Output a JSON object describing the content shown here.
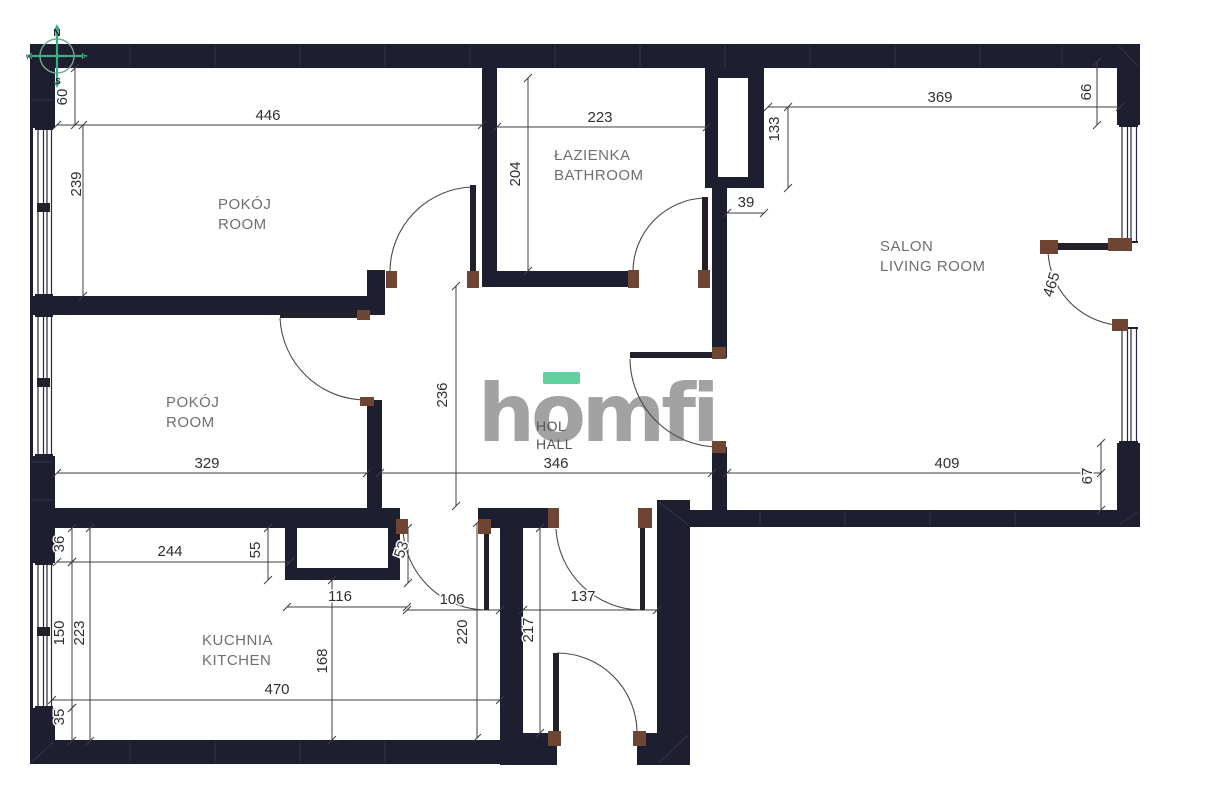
{
  "plan": {
    "canvas": {
      "w": 1208,
      "h": 811
    },
    "colors": {
      "bg": "#ffffff",
      "wall": "#1e1e31",
      "seam": "#32324a",
      "windowLine": "#2a2a3a",
      "dimLine": "#3d3d3d",
      "dimText": "#2f2f2f",
      "roomLabel": "#6f6f6f",
      "hallLabel": "#565656",
      "doorArc": "#4a4a4a",
      "doorLeaf": "#23202a",
      "doorJamb": "#6e4433",
      "logoGray": "#a2a2a2",
      "logoGreen": "#62d1a2",
      "compassGreen": "#3fae7f",
      "compassRing": "#79a892",
      "compassText": "#1a1a2e"
    },
    "walls": [
      [
        30,
        44,
        1110,
        24
      ],
      [
        30,
        44,
        25,
        718
      ],
      [
        1117,
        44,
        23,
        483
      ],
      [
        30,
        740,
        477,
        24
      ],
      [
        500,
        733,
        57,
        32
      ],
      [
        637,
        733,
        53,
        32
      ],
      [
        500,
        508,
        23,
        235
      ],
      [
        657,
        500,
        33,
        265
      ],
      [
        657,
        510,
        483,
        17
      ],
      [
        30,
        508,
        370,
        20
      ],
      [
        478,
        508,
        77,
        20
      ],
      [
        30,
        296,
        338,
        19
      ],
      [
        367,
        270,
        18,
        45
      ],
      [
        367,
        400,
        15,
        110
      ],
      [
        482,
        44,
        15,
        243
      ],
      [
        482,
        271,
        155,
        16
      ],
      [
        705,
        44,
        13,
        144
      ],
      [
        748,
        44,
        16,
        144
      ],
      [
        705,
        177,
        59,
        11
      ],
      [
        705,
        68,
        59,
        10
      ],
      [
        712,
        188,
        15,
        170
      ],
      [
        712,
        447,
        15,
        63
      ],
      [
        285,
        528,
        12,
        52
      ],
      [
        388,
        528,
        12,
        52
      ],
      [
        285,
        568,
        115,
        12
      ]
    ],
    "seams": [
      [
        130,
        45,
        130,
        67
      ],
      [
        215,
        45,
        215,
        67
      ],
      [
        300,
        45,
        300,
        67
      ],
      [
        385,
        45,
        385,
        67
      ],
      [
        470,
        45,
        470,
        67
      ],
      [
        555,
        45,
        555,
        67
      ],
      [
        640,
        45,
        640,
        67
      ],
      [
        725,
        45,
        725,
        67
      ],
      [
        810,
        45,
        810,
        67
      ],
      [
        895,
        45,
        895,
        67
      ],
      [
        980,
        45,
        980,
        67
      ],
      [
        1062,
        45,
        1062,
        67
      ],
      [
        1119,
        46,
        1138,
        66
      ],
      [
        31,
        100,
        54,
        100
      ],
      [
        31,
        462,
        54,
        462
      ],
      [
        31,
        500,
        54,
        500
      ],
      [
        130,
        741,
        130,
        763
      ],
      [
        215,
        741,
        215,
        763
      ],
      [
        300,
        741,
        300,
        763
      ],
      [
        385,
        741,
        385,
        763
      ],
      [
        32,
        762,
        53,
        742
      ],
      [
        760,
        511,
        760,
        526
      ],
      [
        845,
        511,
        845,
        526
      ],
      [
        930,
        511,
        930,
        526
      ],
      [
        1015,
        511,
        1015,
        526
      ],
      [
        1119,
        525,
        1138,
        512
      ],
      [
        659,
        502,
        688,
        525
      ],
      [
        659,
        763,
        688,
        735
      ]
    ],
    "windows": [
      {
        "x": 33,
        "y": 128,
        "w": 22,
        "h": 168,
        "mull": 207
      },
      {
        "x": 33,
        "y": 315,
        "w": 22,
        "h": 141,
        "mull": 382
      },
      {
        "x": 33,
        "y": 563,
        "w": 22,
        "h": 145,
        "mull": 631
      },
      {
        "x": 1117,
        "y": 125,
        "w": 23,
        "h": 118,
        "mull": null
      },
      {
        "x": 1117,
        "y": 327,
        "w": 23,
        "h": 116,
        "mull": null
      }
    ],
    "openings": [
      [
        1117,
        243,
        23,
        84
      ]
    ],
    "door_leaves": [
      [
        470,
        185,
        6,
        88
      ],
      [
        280,
        312,
        87,
        6
      ],
      [
        702,
        197,
        6,
        76
      ],
      [
        630,
        352,
        90,
        6
      ],
      [
        484,
        528,
        5,
        82
      ],
      [
        640,
        525,
        5,
        85
      ],
      [
        553,
        653,
        6,
        80
      ],
      [
        1048,
        243,
        82,
        7
      ]
    ],
    "door_arcs": [
      "M390 272 A85 85 0 0 1 473 187",
      "M280 318 A86 86 0 0 0 366 400",
      "M633 271 A74 74 0 0 1 704 198",
      "M630 359 A89 89 0 0 0 719 447",
      "M403 529 A84 84 0 0 0 487 610",
      "M556 529 A86 86 0 0 0 641 610",
      "M637 732 A80 80 0 0 0 557 653",
      "M1048 250 A77 77 0 0 0 1116 325"
    ],
    "jambs": [
      [
        386,
        271,
        11,
        17
      ],
      [
        467,
        271,
        12,
        17
      ],
      [
        357,
        310,
        13,
        10
      ],
      [
        360,
        397,
        14,
        9
      ],
      [
        628,
        270,
        11,
        18
      ],
      [
        698,
        270,
        12,
        18
      ],
      [
        712,
        347,
        14,
        12
      ],
      [
        712,
        441,
        14,
        12
      ],
      [
        396,
        519,
        12,
        15
      ],
      [
        478,
        519,
        13,
        15
      ],
      [
        548,
        508,
        11,
        20
      ],
      [
        638,
        508,
        14,
        20
      ],
      [
        548,
        731,
        13,
        15
      ],
      [
        633,
        731,
        13,
        15
      ],
      [
        1040,
        240,
        18,
        14
      ],
      [
        1108,
        238,
        24,
        13
      ],
      [
        1112,
        319,
        16,
        12
      ]
    ],
    "dim_lines": [
      [
        57,
        125,
        482,
        125
      ],
      [
        497,
        127,
        707,
        127
      ],
      [
        768,
        107,
        1120,
        107
      ],
      [
        727,
        213,
        764,
        213
      ],
      [
        57,
        473,
        367,
        473
      ],
      [
        380,
        473,
        712,
        473
      ],
      [
        727,
        473,
        1101,
        473
      ],
      [
        57,
        562,
        290,
        562
      ],
      [
        287,
        607,
        407,
        607
      ],
      [
        407,
        610,
        500,
        610
      ],
      [
        523,
        610,
        657,
        610
      ],
      [
        52,
        700,
        500,
        700
      ],
      [
        75,
        68,
        75,
        125
      ],
      [
        83,
        125,
        83,
        296
      ],
      [
        528,
        78,
        528,
        271
      ],
      [
        788,
        107,
        788,
        188
      ],
      [
        1097,
        62,
        1097,
        125
      ],
      [
        456,
        286,
        456,
        506
      ],
      [
        1101,
        443,
        1101,
        510
      ],
      [
        72,
        528,
        72,
        562
      ],
      [
        268,
        528,
        268,
        580
      ],
      [
        408,
        528,
        408,
        583
      ],
      [
        72,
        562,
        72,
        708
      ],
      [
        90,
        528,
        90,
        741
      ],
      [
        72,
        708,
        72,
        741
      ],
      [
        477,
        523,
        477,
        738
      ],
      [
        540,
        528,
        540,
        733
      ],
      [
        332,
        580,
        332,
        740
      ]
    ],
    "dim_labels": [
      {
        "t": "446",
        "x": 268,
        "y": 120,
        "r": 0
      },
      {
        "t": "223",
        "x": 600,
        "y": 122,
        "r": 0
      },
      {
        "t": "369",
        "x": 940,
        "y": 102,
        "r": 0
      },
      {
        "t": "39",
        "x": 746,
        "y": 207,
        "r": 0
      },
      {
        "t": "329",
        "x": 207,
        "y": 468,
        "r": 0
      },
      {
        "t": "346",
        "x": 556,
        "y": 468,
        "r": 0
      },
      {
        "t": "409",
        "x": 947,
        "y": 468,
        "r": 0
      },
      {
        "t": "244",
        "x": 170,
        "y": 556,
        "r": 0
      },
      {
        "t": "116",
        "x": 340,
        "y": 601,
        "r": 0
      },
      {
        "t": "106",
        "x": 452,
        "y": 604,
        "r": 0
      },
      {
        "t": "137",
        "x": 583,
        "y": 601,
        "r": 0
      },
      {
        "t": "470",
        "x": 277,
        "y": 694,
        "r": 0
      },
      {
        "t": "60",
        "x": 67,
        "y": 97,
        "r": -90
      },
      {
        "t": "239",
        "x": 81,
        "y": 184,
        "r": -90
      },
      {
        "t": "204",
        "x": 520,
        "y": 174,
        "r": -90
      },
      {
        "t": "133",
        "x": 779,
        "y": 129,
        "r": -90
      },
      {
        "t": "66",
        "x": 1091,
        "y": 92,
        "r": -90
      },
      {
        "t": "236",
        "x": 447,
        "y": 395,
        "r": -90
      },
      {
        "t": "465",
        "x": 1056,
        "y": 286,
        "r": -72
      },
      {
        "t": "67",
        "x": 1092,
        "y": 476,
        "r": -90
      },
      {
        "t": "36",
        "x": 64,
        "y": 544,
        "r": -90
      },
      {
        "t": "55",
        "x": 260,
        "y": 550,
        "r": -90
      },
      {
        "t": "53",
        "x": 406,
        "y": 551,
        "r": -72
      },
      {
        "t": "150",
        "x": 64,
        "y": 633,
        "r": -90
      },
      {
        "t": "223",
        "x": 84,
        "y": 633,
        "r": -90
      },
      {
        "t": "35",
        "x": 64,
        "y": 717,
        "r": -90
      },
      {
        "t": "220",
        "x": 467,
        "y": 632,
        "r": -90
      },
      {
        "t": "217",
        "x": 533,
        "y": 630,
        "r": -90
      },
      {
        "t": "168",
        "x": 327,
        "y": 661,
        "r": -90
      }
    ],
    "room_labels": [
      {
        "name": "room-1",
        "lines": [
          "POKÓJ",
          "ROOM"
        ],
        "x": 218,
        "y": 209,
        "lh": 20,
        "fs": 15
      },
      {
        "name": "bathroom",
        "lines": [
          "ŁAZIENKA",
          "BATHROOM"
        ],
        "x": 554,
        "y": 160,
        "lh": 20,
        "fs": 15
      },
      {
        "name": "living-room",
        "lines": [
          "SALON",
          "LIVING ROOM"
        ],
        "x": 880,
        "y": 251,
        "lh": 20,
        "fs": 15
      },
      {
        "name": "room-2",
        "lines": [
          "POKÓJ",
          "ROOM"
        ],
        "x": 166,
        "y": 407,
        "lh": 20,
        "fs": 15
      },
      {
        "name": "kitchen",
        "lines": [
          "KUCHNIA",
          "KITCHEN"
        ],
        "x": 202,
        "y": 645,
        "lh": 20,
        "fs": 15
      },
      {
        "name": "hall",
        "lines": [
          "HOL",
          "HALL"
        ],
        "x": 536,
        "y": 431,
        "lh": 18,
        "fs": 14
      }
    ],
    "logo": {
      "text": "homfi",
      "x": 478,
      "y": 441,
      "fs": 80,
      "ls": -4,
      "bar": [
        543,
        372,
        37,
        12
      ]
    },
    "compass": {
      "cx": 57,
      "cy": 56,
      "r": 17,
      "n": "N",
      "s": "S",
      "e": "E",
      "w": "W"
    }
  }
}
